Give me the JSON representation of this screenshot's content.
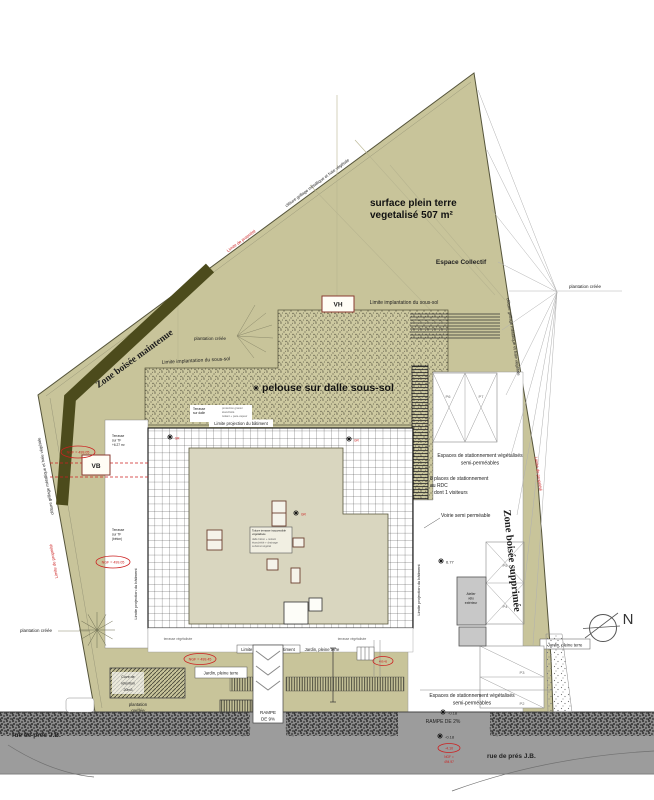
{
  "colors": {
    "site_green": "#c8c49a",
    "dark_band": "#4c4b1c",
    "roof": "#d9d6bf",
    "street_gray": "#9c9c9c",
    "annotation_red": "#cc2020",
    "marker_border": "#8a3a30"
  },
  "annotations": {
    "title_line1": "surface plein terre",
    "title_line2": "vegetalisé 507 m²",
    "espace_collectif": "Espace Collectif",
    "pelouse": "pelouse sur dalle sous-sol",
    "zone_boisee_maintenue": "Zone boisée maintenue",
    "zone_boisee_supprimee": "Zone boisée supprimée",
    "limite_implantation_sous_sol": "Limite implantation du sous-sol",
    "limite_projection_batiment": "Limite projection du bâtiment",
    "plantation_creee": "plantation créée",
    "plantation_gardee_1": "plantation",
    "plantation_gardee_2": "gardée",
    "cloture": "clôture grillage métallique et haie végétale",
    "limite_propriete": "Limite de propriété",
    "terrasse_vegetalisee": "terrasse végétalisée"
  },
  "building": {
    "vh": "VH",
    "vb": "VB",
    "legend": [
      "Toiture terrasse inaccessible",
      "végétalisée",
      "dalle béton + isolant",
      "étanchéité + drainage",
      "substrat végétal"
    ],
    "terrasse_tf": [
      "Terrasse",
      "sur TF",
      "+6.27 m²"
    ],
    "terrasse_tf2": [
      "Terrasse",
      "sur TF",
      "(béton)"
    ],
    "header_left": [
      "Terrasse",
      "sur dalle"
    ],
    "header_right": [
      "protection gravier",
      "étanchéité",
      "isolant + pare-vapeur"
    ]
  },
  "parking": {
    "stationnement_1": "Espaces de stationnement végétalisés",
    "stationnement_2": "semi-perméables",
    "places_1": "8 places de stationnement",
    "places_2": "au RDC",
    "places_3": "dont 1 visiteurs",
    "voirie": "Voirie semi perméable",
    "rampe9_1": "RAMPE",
    "rampe9_2": "DE 9%",
    "rampe2": "RAMPE DE 2%",
    "jardin": "Jardin, pleine terre",
    "cuve": [
      "Cuve de",
      "rétention",
      "20m3"
    ],
    "atelier": [
      "Atelier",
      "vélo",
      "extérieur"
    ],
    "p2": "P2",
    "p3": "P3",
    "p4": "P4",
    "p5": "P5",
    "p6": "P6",
    "p7": "P7"
  },
  "street": {
    "rue": "rue de prés J.B.",
    "north": "N"
  },
  "markers": {
    "sr": "SR",
    "gr": "GR",
    "elev_677": "6.77",
    "elev_018": "-0.18",
    "ngf_left_upper": "NGF = 499.05",
    "ngf_left_lower": "NGF = 499.05",
    "ngf_bottom": "NGF = 499.45",
    "ngf_small": "499.45",
    "street_oval": "-4.10",
    "street_ngf_1": "NGF =",
    "street_ngf_2": "494.97"
  }
}
